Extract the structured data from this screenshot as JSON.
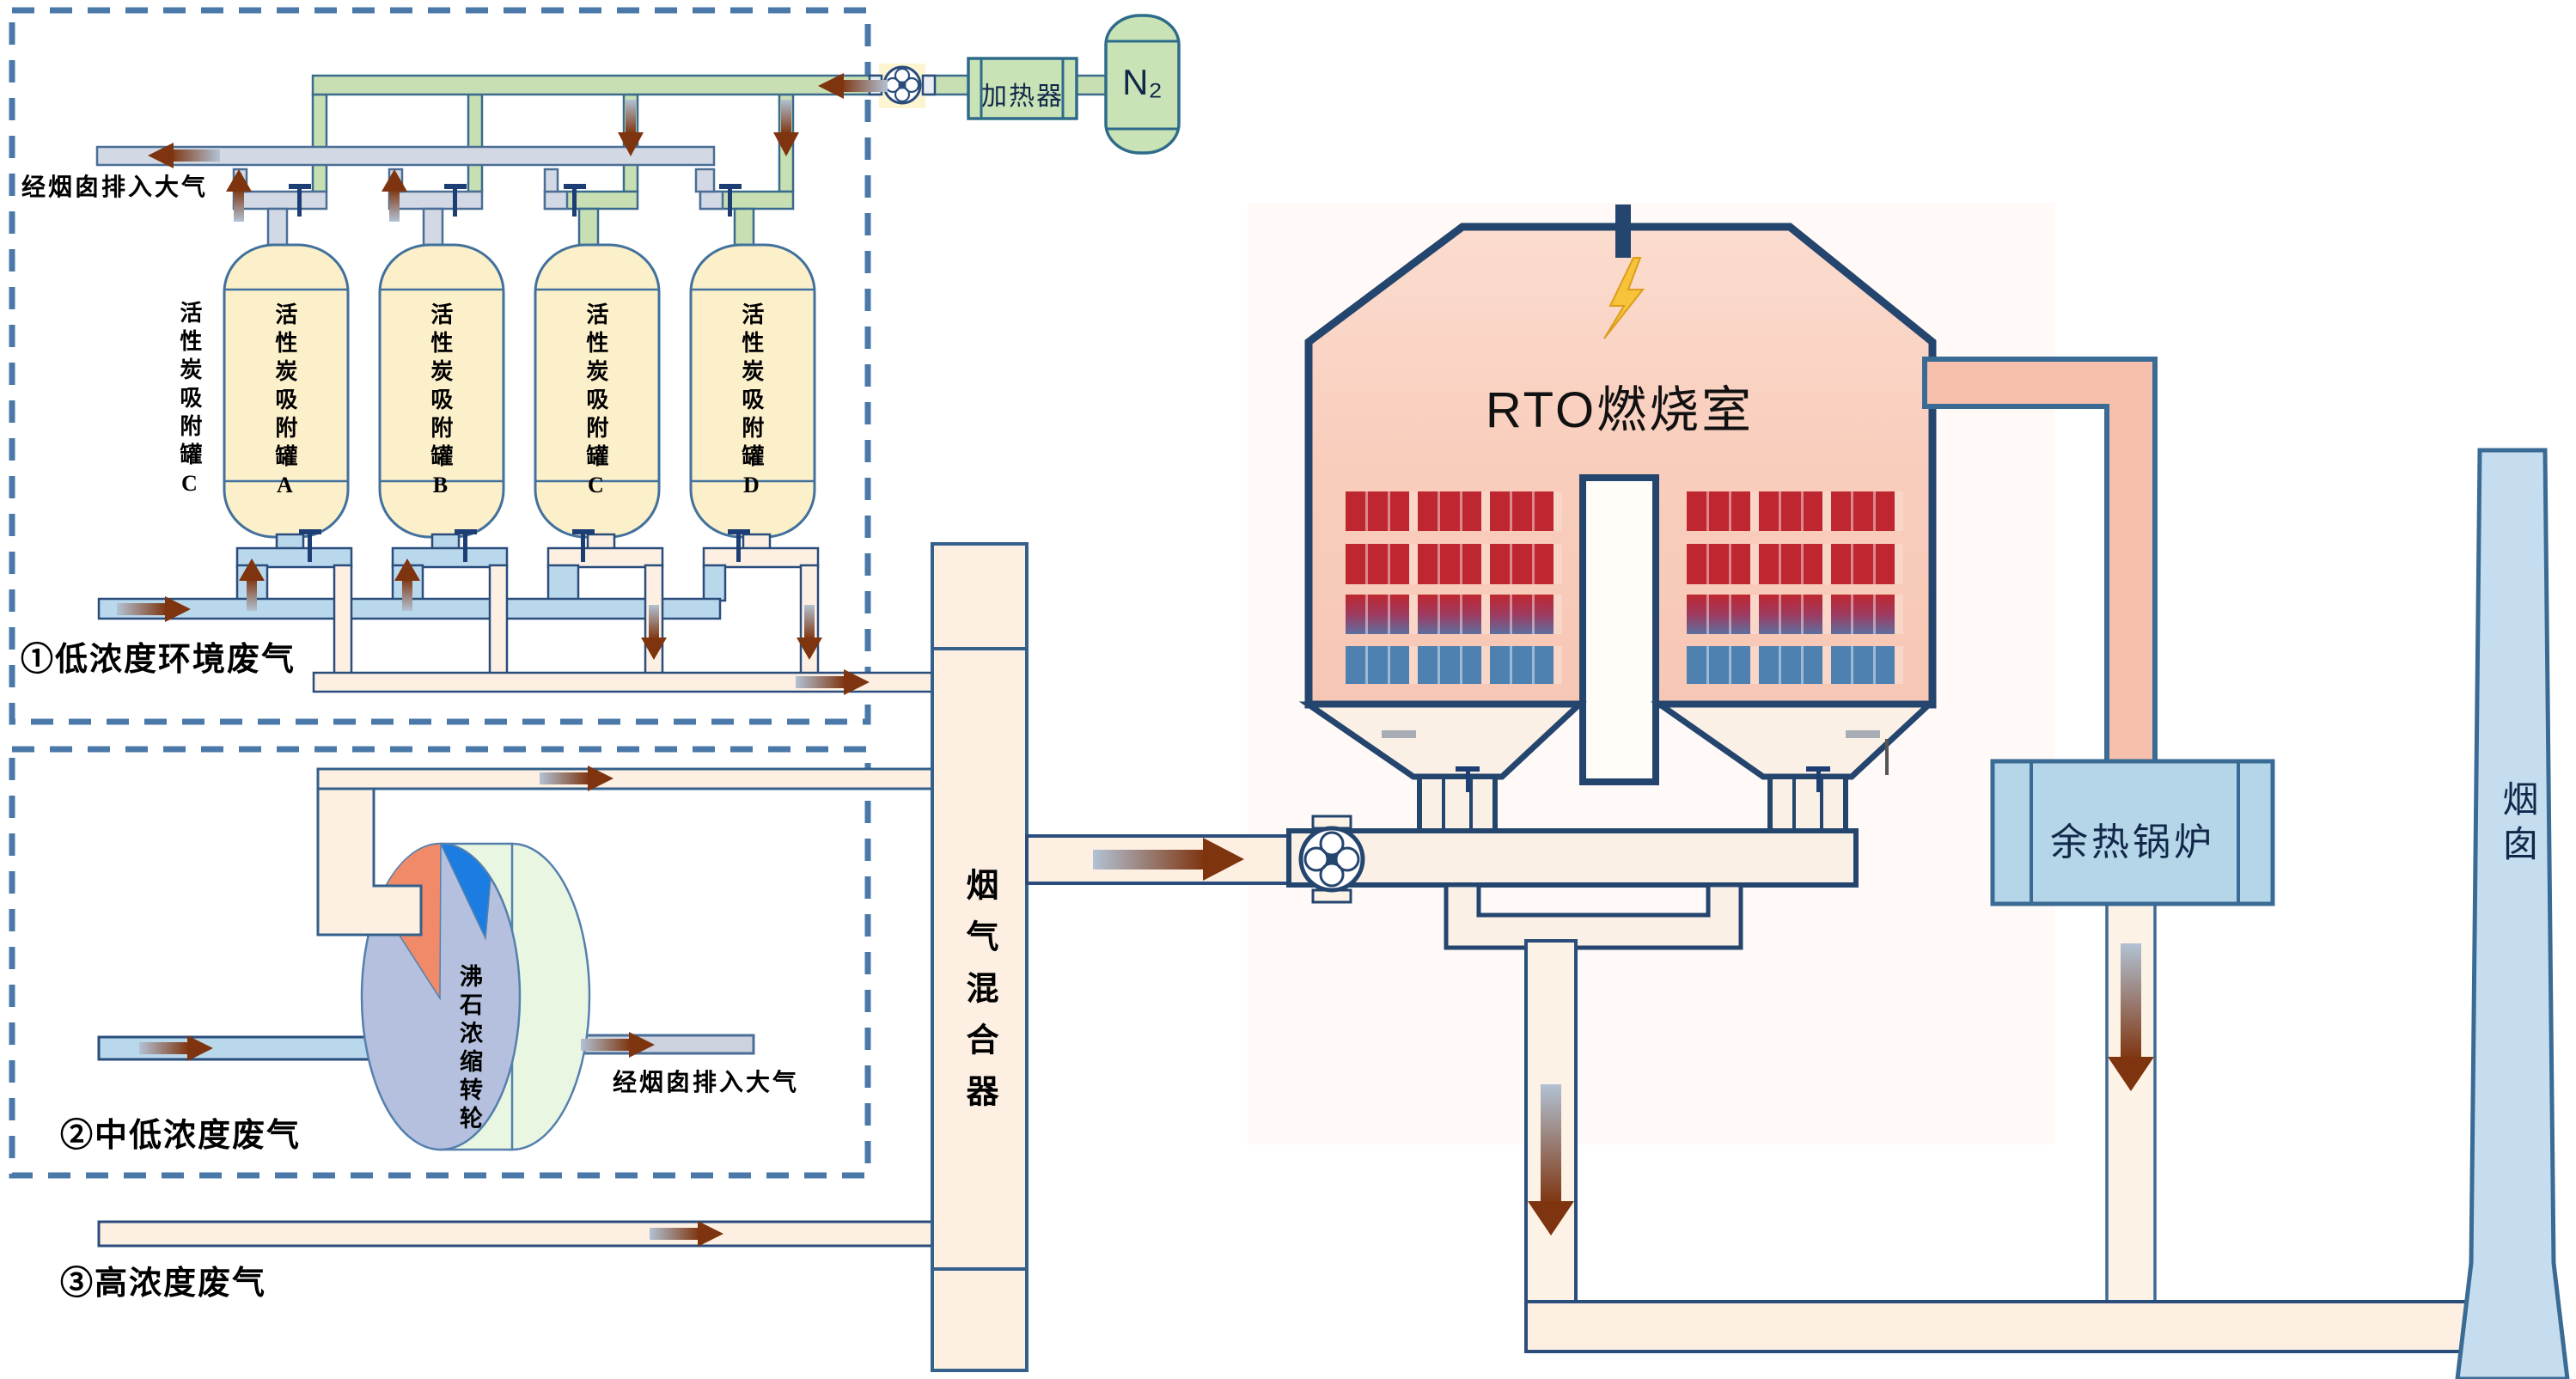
{
  "diagram_title": "RTO waste gas treatment process flow",
  "sections": {
    "low": {
      "label": "①低浓度环境废气",
      "exhaust_label": "经烟囱排入大气",
      "stray_tank_label": "活性炭吸附罐C",
      "tanks": [
        {
          "label": "活性炭吸附罐A"
        },
        {
          "label": "活性炭吸附罐B"
        },
        {
          "label": "活性炭吸附罐C"
        },
        {
          "label": "活性炭吸附罐D"
        }
      ]
    },
    "mid": {
      "label": "②中低浓度废气",
      "rotor_label": "沸石浓缩转轮",
      "exhaust_label": "经烟囱排入大气"
    },
    "high": {
      "label": "③高浓度废气"
    }
  },
  "equipment": {
    "mixer": {
      "label": "烟气混合器"
    },
    "rto": {
      "label": "RTO燃烧室"
    },
    "boiler": {
      "label": "余热锅炉"
    },
    "chimney": {
      "label": "烟囱"
    },
    "heater": {
      "label": "加热器"
    },
    "nitrogen_tank": {
      "label": "N₂"
    }
  },
  "icons": [
    "fan-icon",
    "valve-icon",
    "lightning-icon",
    "flow-arrow"
  ],
  "colors": {
    "nitrogen_pipe": "#c7dfb2",
    "exhaust_pipe": "#d3d9e4",
    "waste_gas_pipe": "#b9d8ec",
    "desorb_pipe": "#fdf0e3",
    "tank_fill": "#fcf0cb",
    "rto_fill": "#f9cfbe",
    "rto_outline": "#24456e",
    "bed_hot": "#bf2730",
    "bed_cold": "#4e80b0",
    "boiler_fill": "#b5d6e8",
    "chimney_fill": "#c5ddee",
    "dashed_border": "#4a78a8",
    "flow_arrow": "#7e340e"
  }
}
